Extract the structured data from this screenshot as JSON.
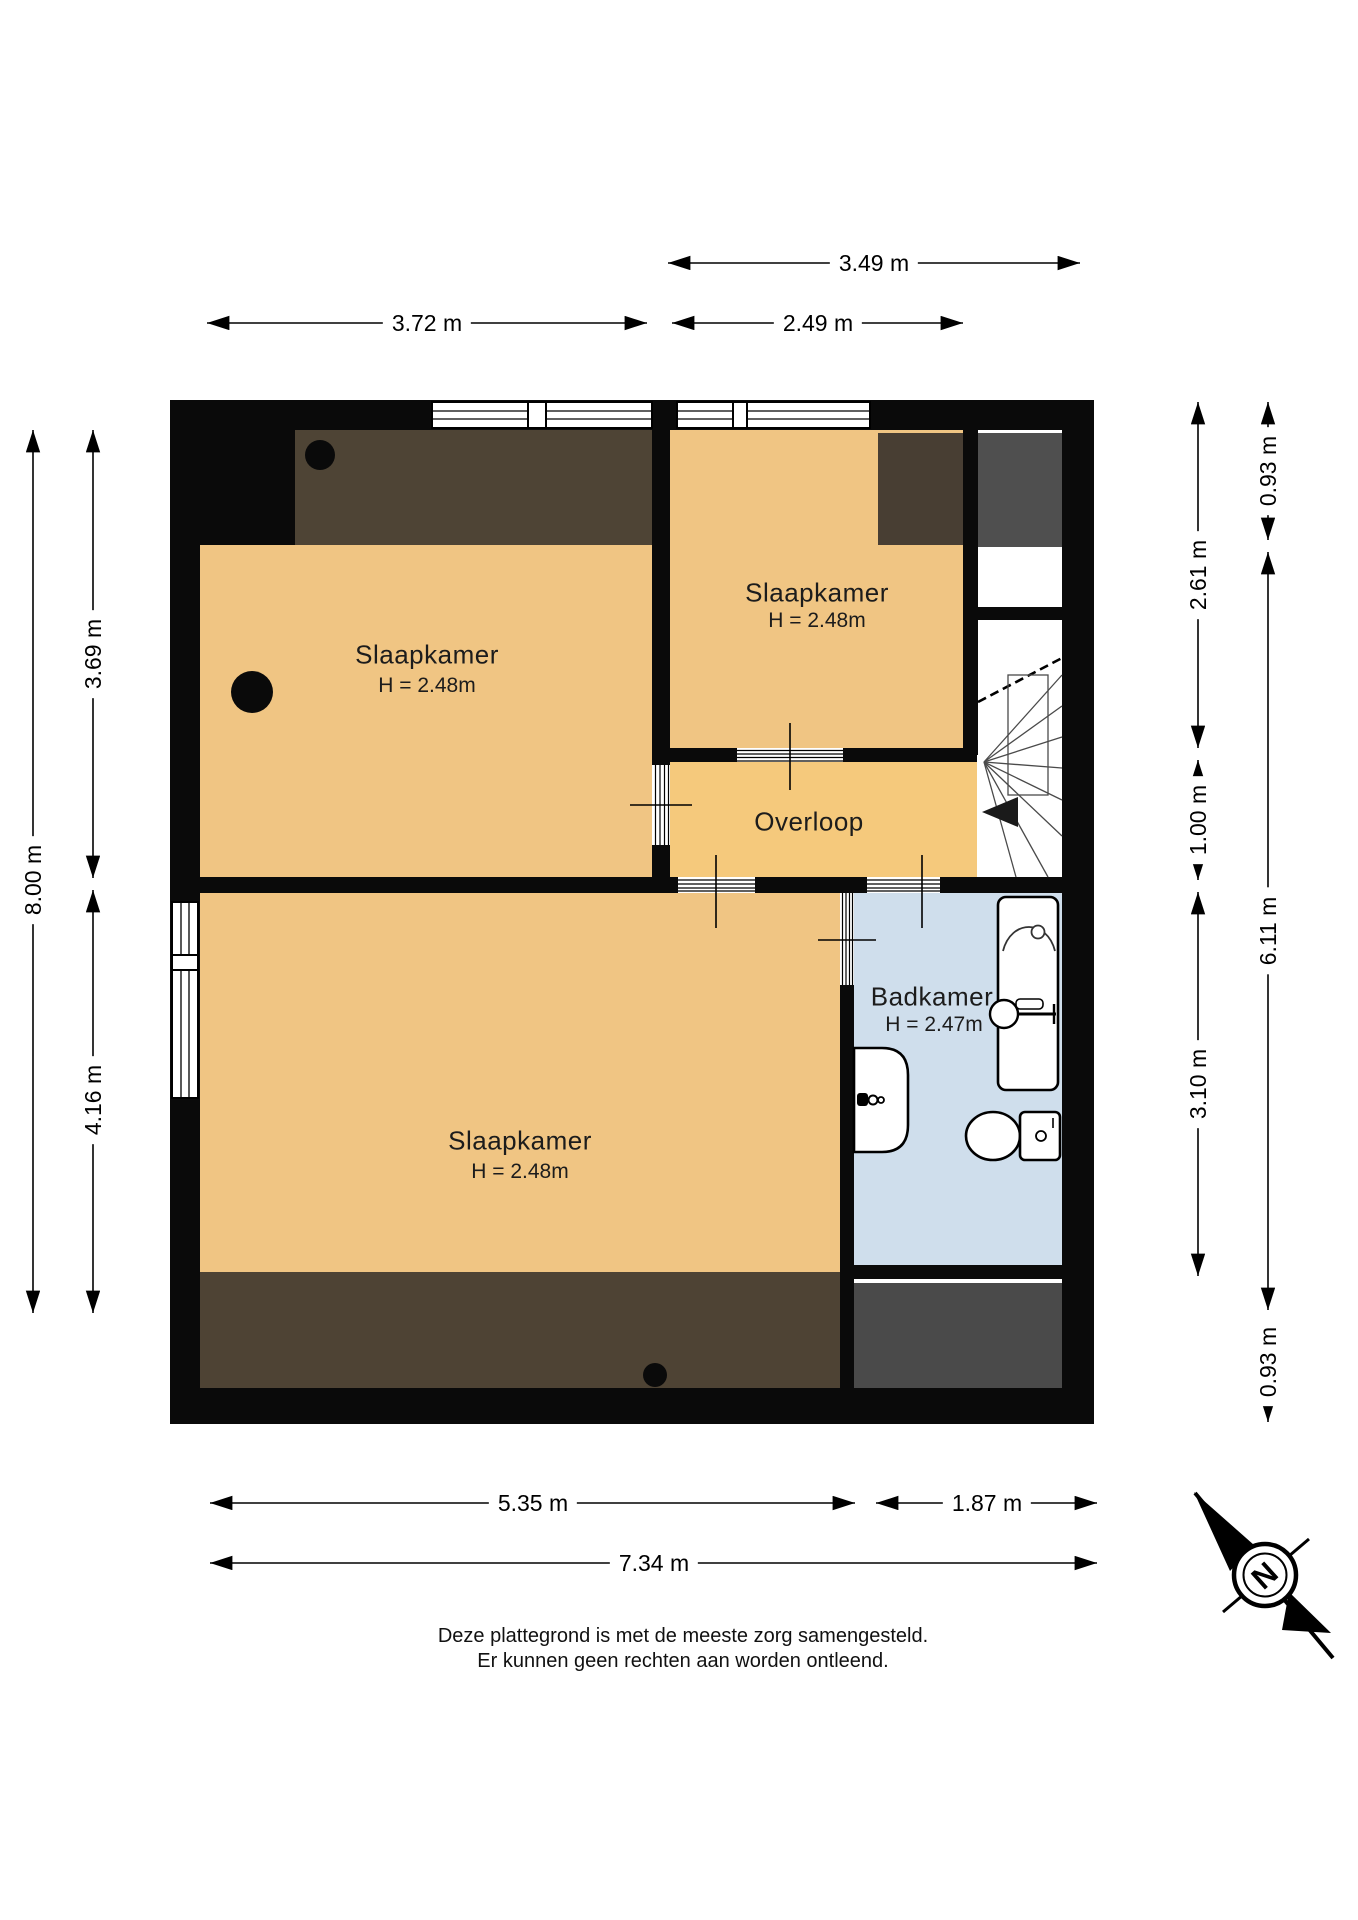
{
  "floorplan": {
    "title_hidden": "",
    "rooms": [
      {
        "name": "Slaapkamer",
        "height": "H = 2.48m",
        "position": "top-left"
      },
      {
        "name": "Slaapkamer",
        "height": "H = 2.48m",
        "position": "top-right"
      },
      {
        "name": "Overloop",
        "height": "",
        "position": "center"
      },
      {
        "name": "Slaapkamer",
        "height": "H = 2.48m",
        "position": "bottom"
      },
      {
        "name": "Badkamer",
        "height": "H = 2.47m",
        "position": "right"
      }
    ],
    "dimensions": {
      "top": [
        "3.49 m",
        "3.72 m",
        "2.49 m"
      ],
      "bottom": [
        "5.35 m",
        "1.87 m",
        "7.34 m"
      ],
      "left": [
        "8.00 m",
        "3.69 m",
        "4.16 m"
      ],
      "right_inner": [
        "2.61 m",
        "1.00 m",
        "3.10 m"
      ],
      "right_outer": [
        "0.93 m",
        "6.11 m",
        "0.93 m"
      ]
    },
    "fixtures": [
      "stairs",
      "bathtub",
      "shower",
      "washbasin",
      "toilet"
    ],
    "compass": {
      "north_label": "N"
    },
    "footer": {
      "line1": "Deze plattegrond is met de meeste zorg samengesteld.",
      "line2": "Er kunnen geen rechten aan worden ontleend."
    },
    "colors": {
      "wall": "#0a0a0a",
      "floor": "#f0c583",
      "floor_hall": "#f5c97c",
      "floor_bath": "#cfdeec",
      "sloped_dark_brown": "#4e4435",
      "sloped_gray": "#4f4f4f"
    }
  }
}
